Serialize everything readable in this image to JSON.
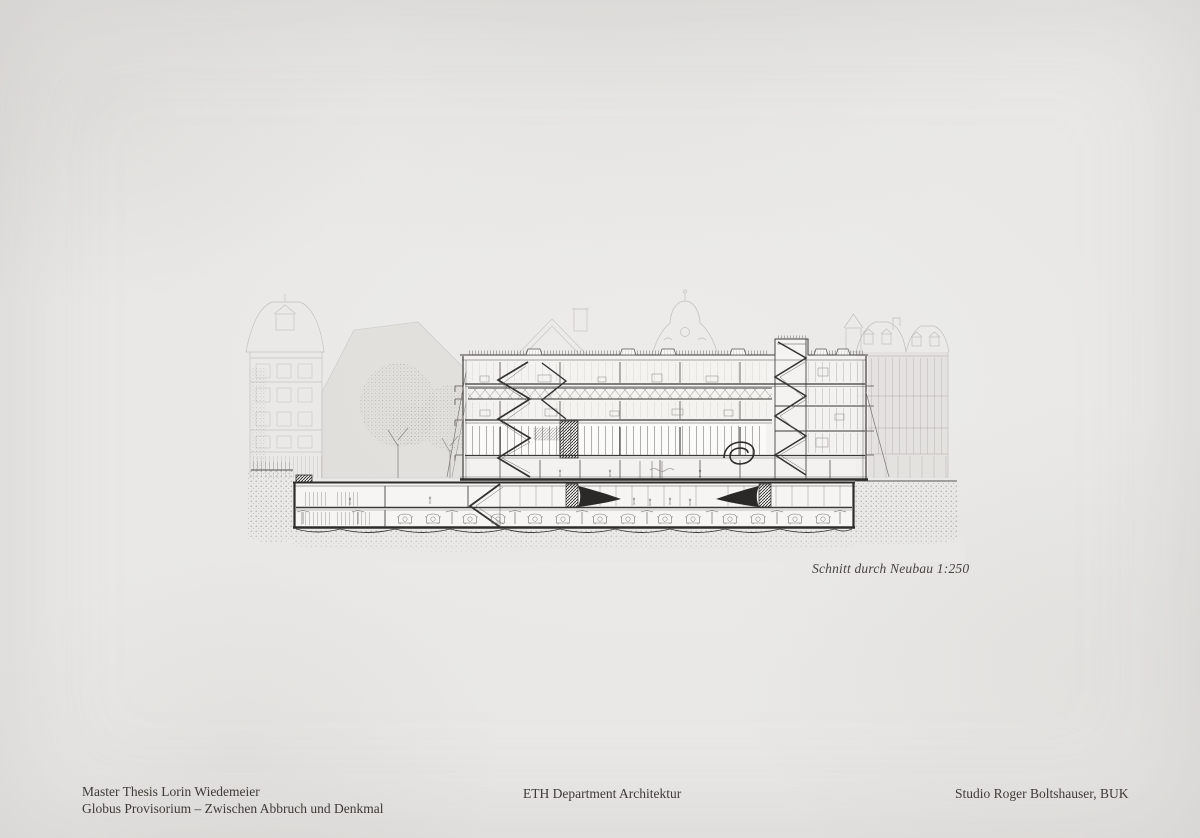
{
  "board": {
    "type": "architectural-presentation-board",
    "colors": {
      "paper": "#e9e8e6",
      "ink": "#3e3b38",
      "cut_ink": "#2e2c2a",
      "faint_ink": "#c6c3bf",
      "earth_dot": "#97948f"
    }
  },
  "drawing": {
    "caption": "Schnitt durch Neubau 1:250"
  },
  "footer": {
    "left_line1": "Master Thesis Lorin Wiedemeier",
    "left_line2": "Globus Provisorium – Zwischen Abbruch und Denkmal",
    "center": "ETH Department Architektur",
    "right": "Studio Roger Boltshauser, BUK"
  }
}
